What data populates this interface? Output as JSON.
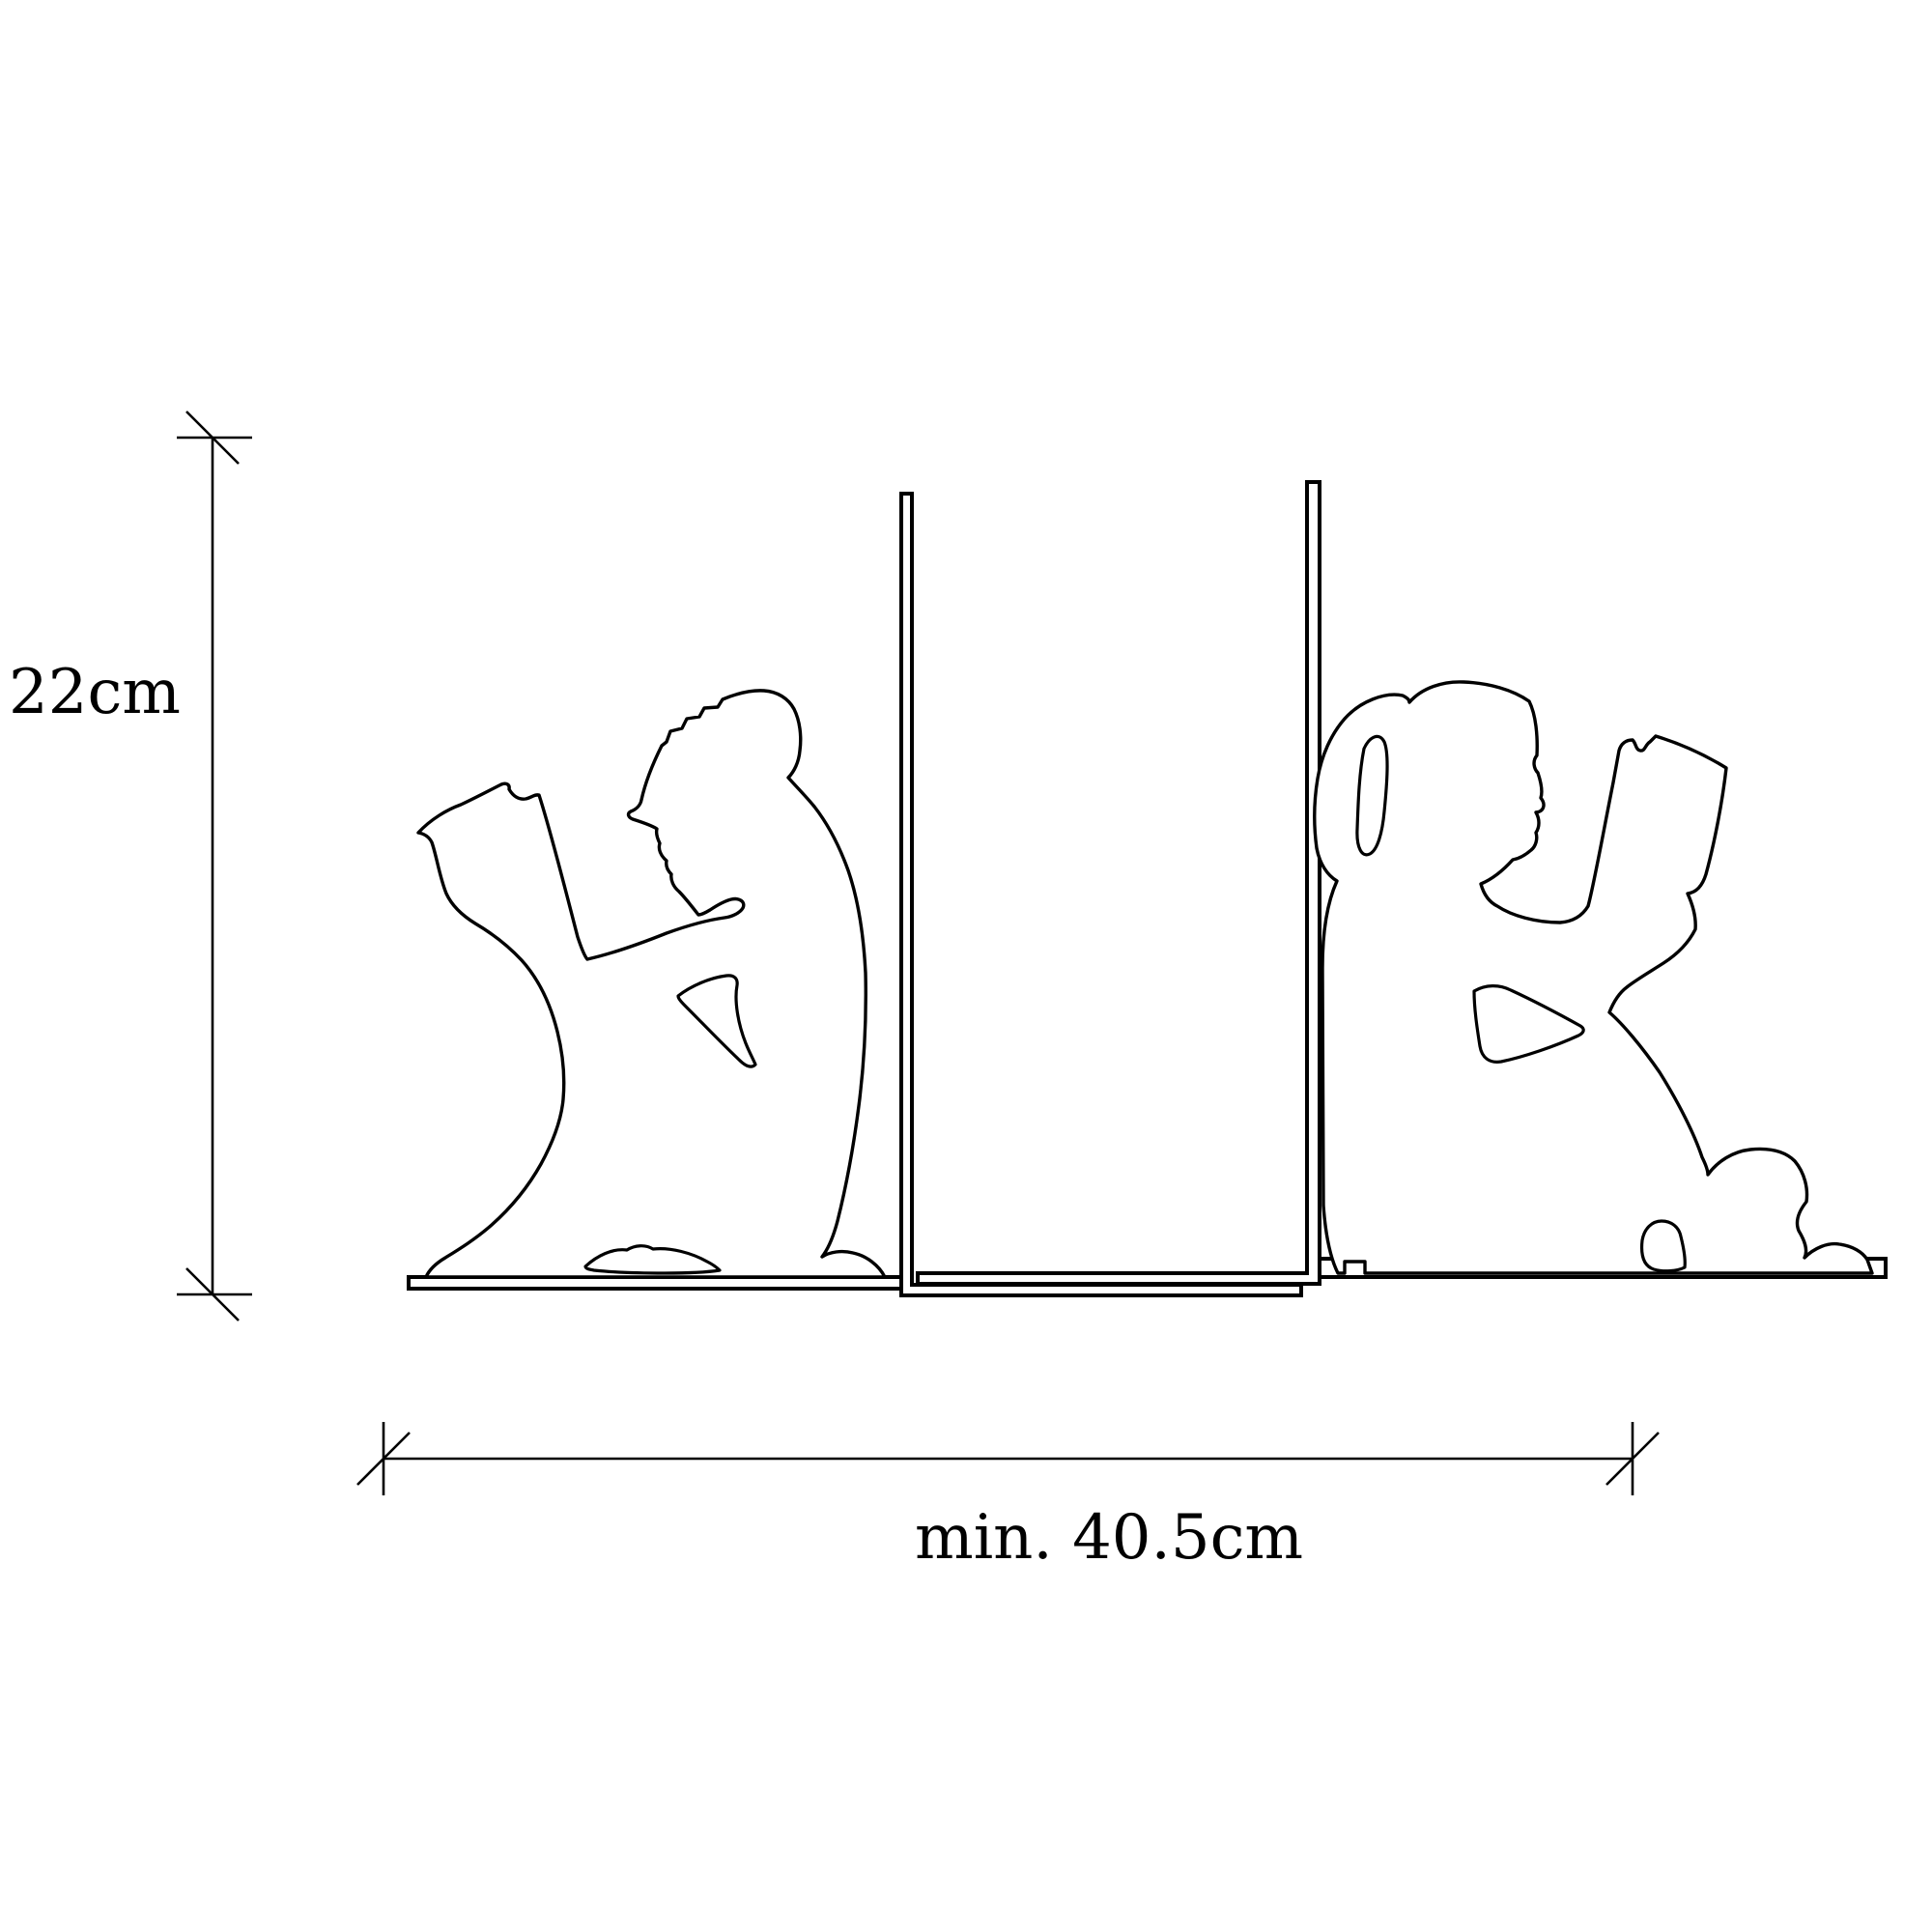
{
  "drawing": {
    "title": "Bookend dimension drawing",
    "style": "technical line drawing",
    "background_color": "#ffffff",
    "line_color": "#000000"
  },
  "dimensions": {
    "height": {
      "label": "22cm"
    },
    "width": {
      "label": "min. 40.5cm"
    }
  },
  "parts": {
    "left_figure": "boy-reading-silhouette",
    "right_figure": "girl-reading-silhouette",
    "left_plate": "left-bookend-plate",
    "right_plate": "right-bookend-plate",
    "left_base": "boy-base-strip",
    "right_base": "girl-base-strip"
  }
}
